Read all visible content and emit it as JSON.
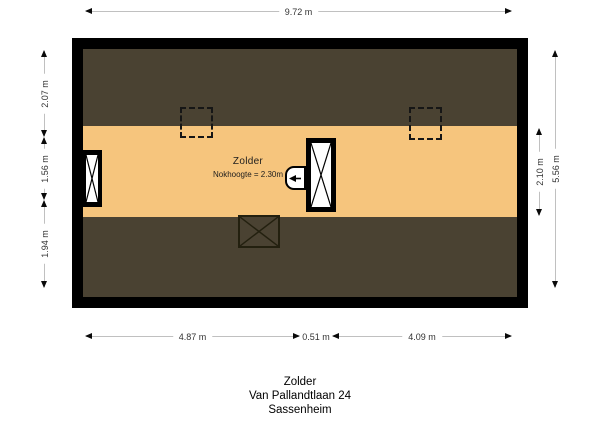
{
  "colors": {
    "wall": "#000000",
    "roof": "#4a4232",
    "floor": "#f6c57d",
    "dim_line": "#c0c0c0",
    "dim_text": "#333333"
  },
  "dimensions": {
    "top": "9.72 m",
    "left": [
      "2.07 m",
      "1.56 m",
      "1.94 m"
    ],
    "right_inner": "2.10 m",
    "right_outer": "5.56 m",
    "bottom": [
      "4.87 m",
      "0.51 m",
      "4.09 m"
    ]
  },
  "room": {
    "name": "Zolder",
    "ridge_height": "Nokhoogte = 2.30m"
  },
  "title": {
    "line1": "Zolder",
    "line2": "Van Pallandtlaan 24",
    "line3": "Sassenheim"
  }
}
